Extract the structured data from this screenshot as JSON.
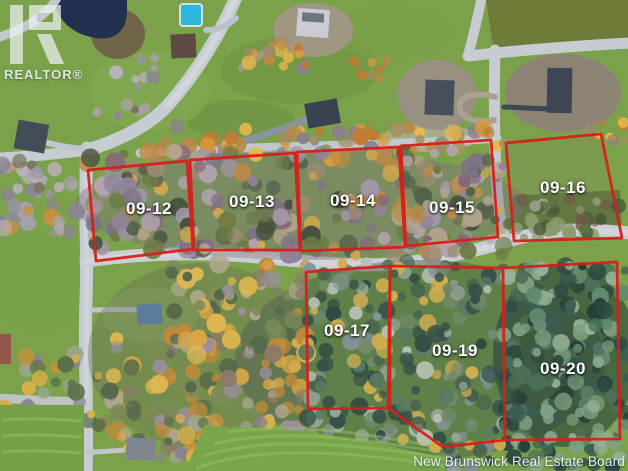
{
  "branding": {
    "logo_text": "REALTOR®"
  },
  "lots": [
    {
      "label": "09-12"
    },
    {
      "label": "09-13"
    },
    {
      "label": "09-14"
    },
    {
      "label": "09-15"
    },
    {
      "label": "09-16"
    },
    {
      "label": "09-17"
    },
    {
      "label": "09-19"
    },
    {
      "label": "09-20"
    }
  ],
  "watermark": {
    "text": "New Brunswick Real Estate Board"
  },
  "colors": {
    "lot_boundary": "#d62019",
    "lot_label": "#ffffff",
    "watermark": "#ffffff"
  }
}
